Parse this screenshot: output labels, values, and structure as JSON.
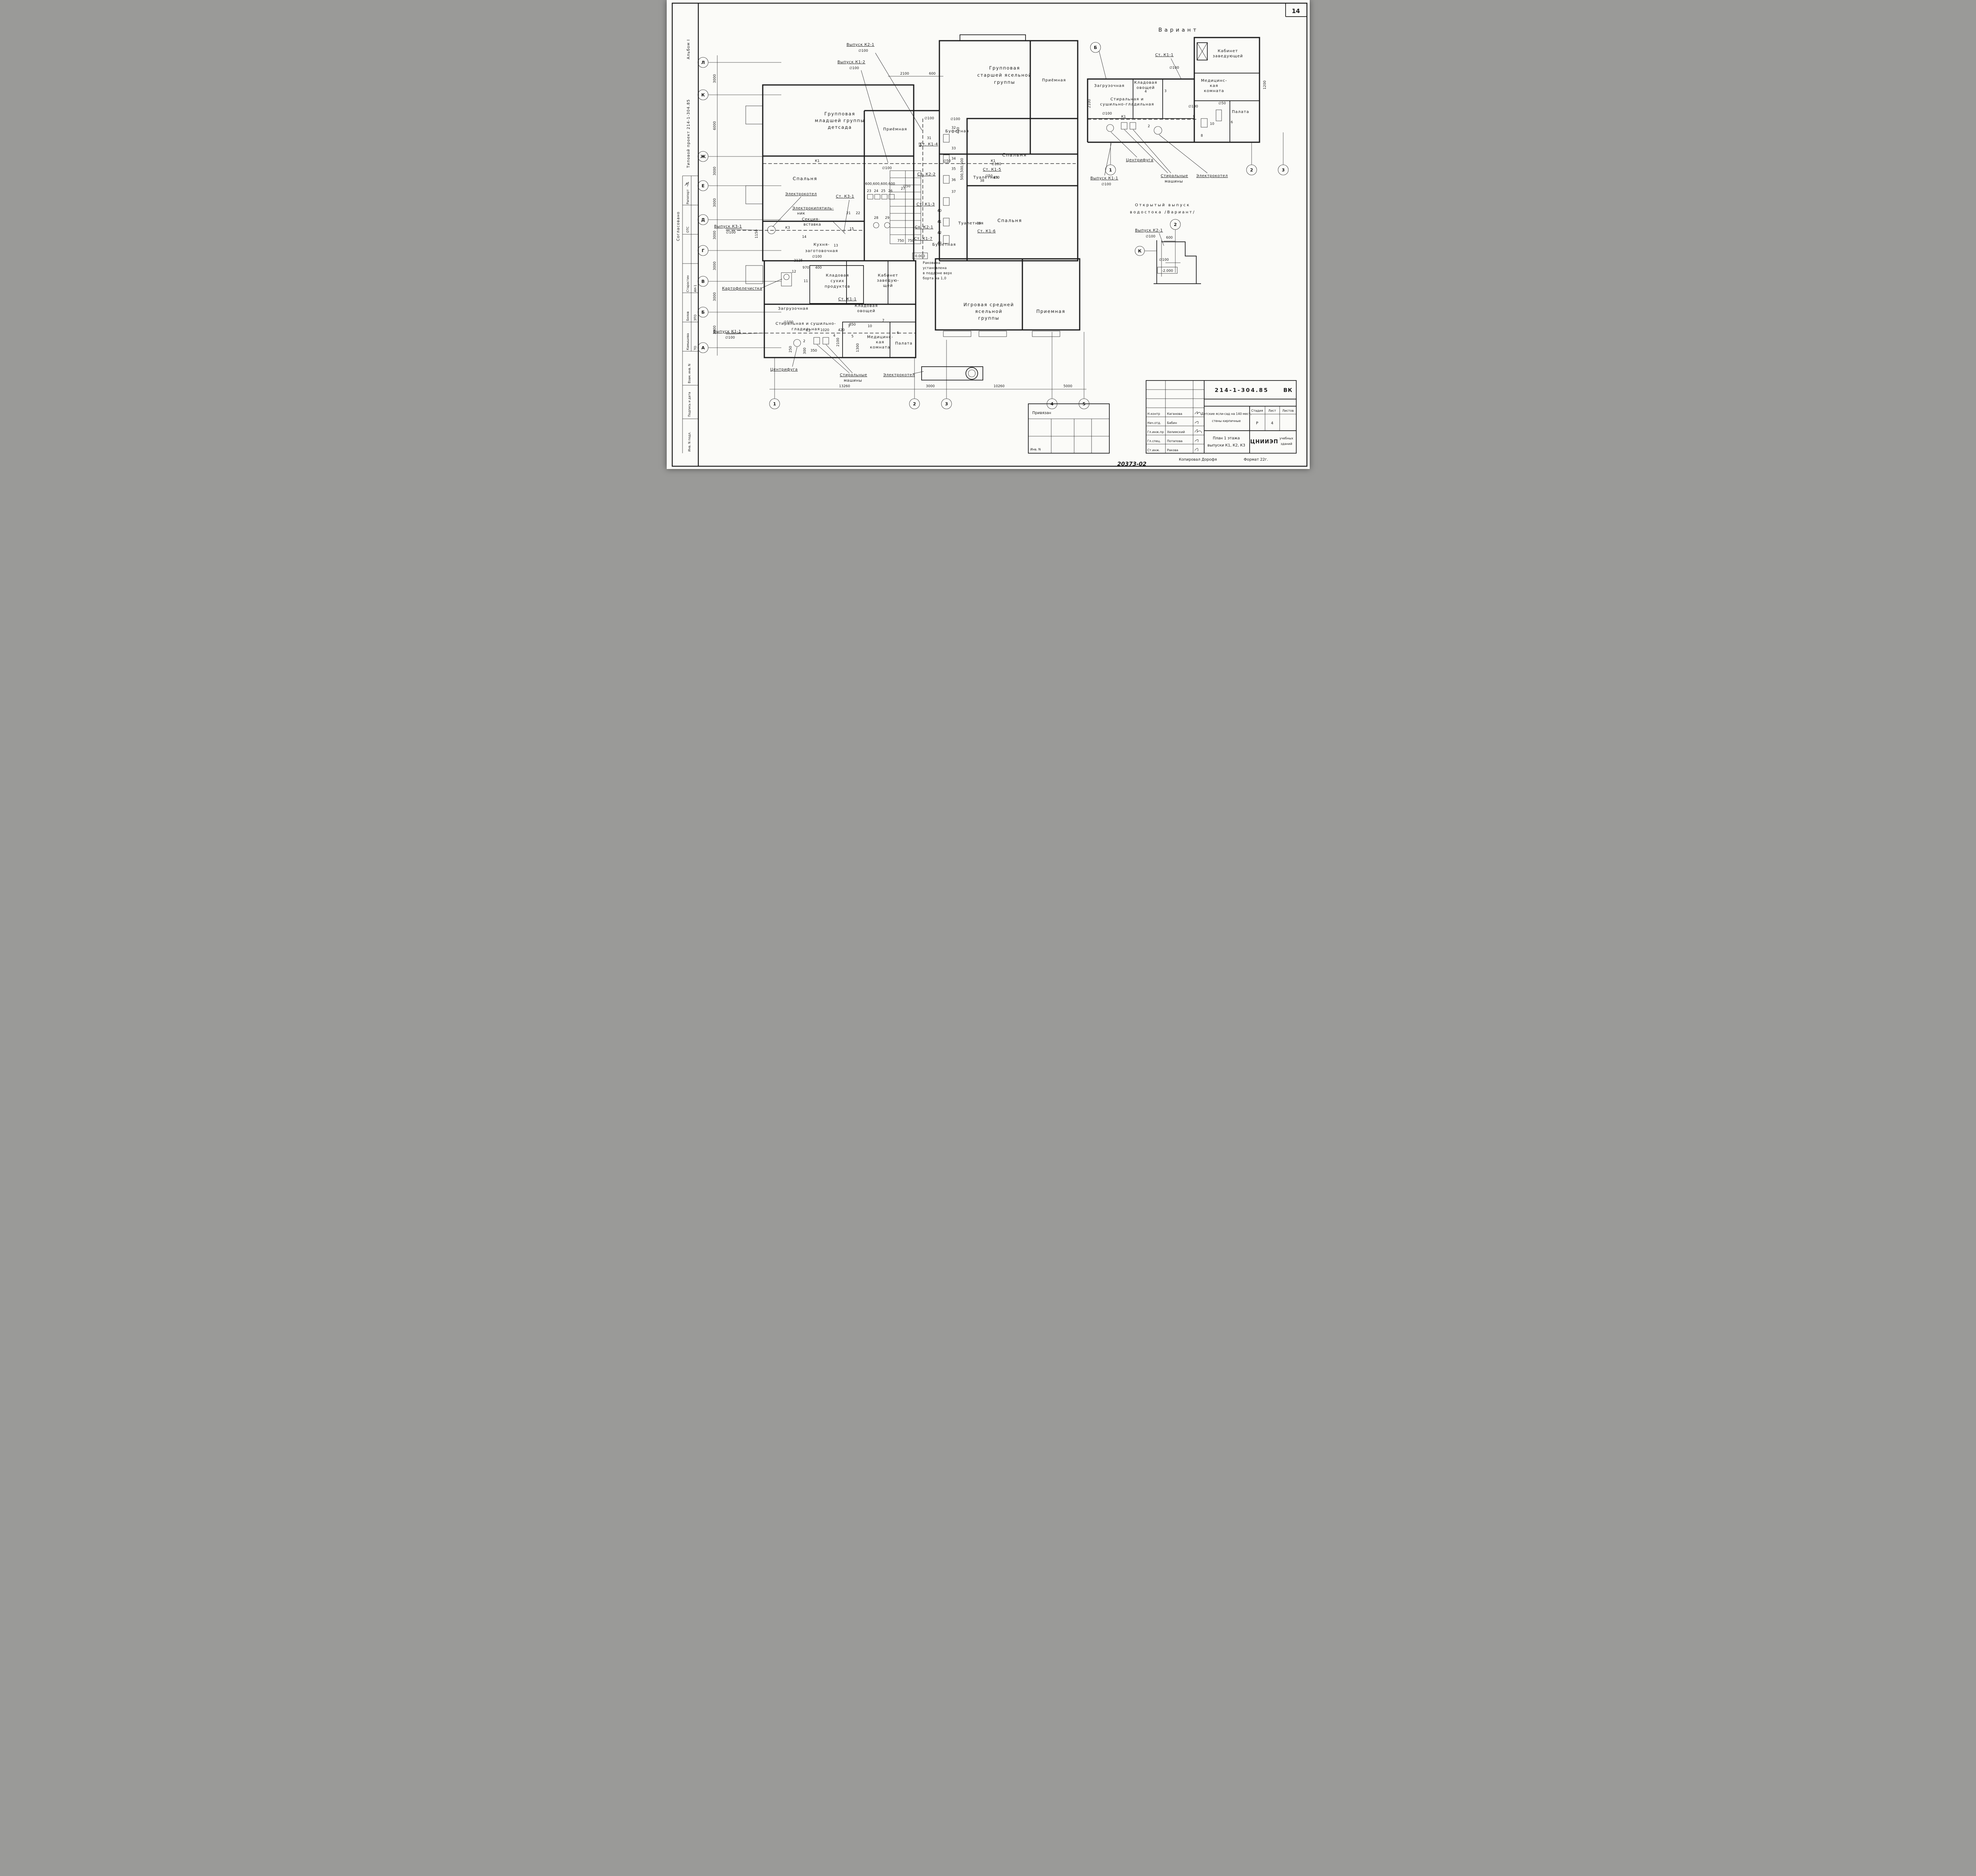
{
  "page": {
    "number": "14"
  },
  "strip": {
    "album": "Альбом I",
    "project": "Типовой проект 214-1-304.85",
    "agreed": "Согласовано",
    "ots_dept": "ОТС",
    "ots_name": "Рапопорт",
    "approvers": [
      [
        "АН-1",
        "Старостин"
      ],
      [
        "ЭТО",
        "Белов"
      ],
      [
        "ТО",
        "Камышева"
      ]
    ],
    "fields": [
      "Взам. инв. N",
      "Подпись и дата",
      "Инв. N подл."
    ]
  },
  "axes": {
    "left": [
      "Л",
      "К",
      "Ж",
      "Е",
      "Д",
      "Г",
      "В",
      "Б",
      "А"
    ],
    "left_dims": [
      "3000",
      "6000",
      "3000",
      "3000",
      "3000",
      "3000",
      "3000",
      "3000"
    ],
    "bottom": [
      "1",
      "2",
      "3",
      "4",
      "5"
    ],
    "bottom_dims": [
      "13260",
      "3000",
      "10260",
      "5000"
    ]
  },
  "rooms": {
    "group_younger": [
      "Групповая",
      "младшей группы",
      "детсада"
    ],
    "bedroom_left": "Спальня",
    "reception_center": "Приёмная",
    "group_older": [
      "Групповая",
      "старшей ясельной",
      "группы"
    ],
    "reception_top": "Приёмная",
    "buffet": "Буфетная",
    "toilet_top": "Туалетная",
    "bedroom_top": "Спальня",
    "toilet_low": "Туалетная",
    "bedroom_low": "Спальня",
    "buffet_low": "Буфетная",
    "playroom": [
      "Игровая средней",
      "ясельной",
      "группы"
    ],
    "reception_low": "Приемная",
    "kitchen": [
      "Кухня-",
      "заготовочная"
    ],
    "pantry_dry": [
      "Кладовая",
      "сухих",
      "продуктов"
    ],
    "office": [
      "Кабинет",
      "заведую-",
      "щей"
    ],
    "loading": "Загрузочная",
    "pantry_veg": [
      "Кладовая",
      "овощей"
    ],
    "laundry": [
      "Стиральная и сушильно-",
      "гладильная"
    ],
    "med": [
      "Медицинс-",
      "кая",
      "комната"
    ],
    "ward": "Палата"
  },
  "equip": {
    "boiler": "Электрокотел",
    "heater": [
      "Электрокипятиль-",
      "ник"
    ],
    "section": [
      "Секция-",
      "вставка"
    ],
    "peeler": "Картофелечистка",
    "centrifuge": "Центрифуга",
    "washers": [
      "Стиральные",
      "машины"
    ],
    "boiler2": "Электрокотел",
    "sink_note": [
      "Раковина",
      "установлена",
      "в поддоне верх",
      "борта на 1,0"
    ]
  },
  "outlets": {
    "k3_1": "Выпуск К3-1",
    "k1_1": "Выпуск К1-1",
    "k1_2": "Выпуск К1-2",
    "k2_1": "Выпуск К2-1"
  },
  "stacks": {
    "k1_1": "Ст. К1-1",
    "k1_3": "Ст. К1-3",
    "k1_4": "Ст. К1-4",
    "k1_5": "Ст. К1-5",
    "k1_6": "Ст. К1-6",
    "k1_7": "Ст. К1-7",
    "k2_1": "Ст. К2-1",
    "k2_2": "Ст. К2-2",
    "k3_1": "Ст. К3-1"
  },
  "pipes": {
    "k1": "К1",
    "k2": "К2",
    "k3": "К3"
  },
  "dims": {
    "d2100": "2100",
    "d600": "600",
    "d2125": "2125",
    "d970": "970",
    "d400": "400",
    "d1150": "1150",
    "d250": "250",
    "d300": "300",
    "d1020": "1020",
    "d420": "420",
    "d850": "850",
    "d1300": "1300",
    "d750": "750",
    "d350": "350",
    "d450": "450",
    "d1200": "1200",
    "d500x3": "500,500,500",
    "d600x4": "600,600,600,600",
    "dia100": "∅100",
    "dia50": "∅50",
    "elev0": "0.000",
    "elev_m2": "-2.000"
  },
  "nums": {
    "2": "2",
    "3": "3",
    "4": "4",
    "5": "5",
    "6": "6",
    "7": "7",
    "8": "8",
    "9": "9",
    "10": "10",
    "11": "11",
    "12": "12",
    "13": "13",
    "14": "14",
    "15": "15",
    "21": "21",
    "22": "22",
    "23": "23",
    "24": "24",
    "25": "25",
    "26": "26",
    "27": "27",
    "28": "28",
    "29": "29",
    "31": "31",
    "32": "32",
    "33": "33",
    "34": "34",
    "35": "35",
    "36": "36",
    "37": "37",
    "38": "38",
    "39": "39",
    "40": "40",
    "41": "41",
    "42": "42",
    "43": "43"
  },
  "variant": {
    "title": "Вариант",
    "axis_b": "Б",
    "axes": [
      "1",
      "2",
      "3"
    ],
    "office": [
      "Кабинет",
      "заведующей"
    ],
    "laundry": [
      "Стиральная и",
      "сушильно-гладильная"
    ]
  },
  "detail": {
    "title": [
      "Открытый выпуск",
      "водостока /Вариант/"
    ],
    "axis2": "2",
    "axisk": "К"
  },
  "title_block": {
    "code": "214-1-304.85",
    "mark": "ВК",
    "object": [
      "Детские ясли-сад на 140 мест,",
      "стены кирпичные"
    ],
    "sheet_title": [
      "План 1 этажа",
      "выпуски К1, К2, К3"
    ],
    "org": "ЦНИИЭП",
    "org2": [
      "учебных",
      "зданий"
    ],
    "stage_label": "Стадия",
    "sheet_label": "Лист",
    "sheets_label": "Листов",
    "stage": "Р",
    "sheet": "4",
    "roles": [
      [
        "Н.контр",
        "Каганова"
      ],
      [
        "Нач.отд.",
        "Бабин"
      ],
      [
        "Гл.инж.пр",
        "Хелимский"
      ],
      [
        "Гл.спец.",
        "Потапова"
      ],
      [
        "Ст.инж.",
        "Ракова"
      ]
    ],
    "binding": "Привязан",
    "inv": "Инв. N",
    "copied": "Копировал  Дорофя",
    "format": "Формат 22г.",
    "doc_no": "20373-02"
  }
}
